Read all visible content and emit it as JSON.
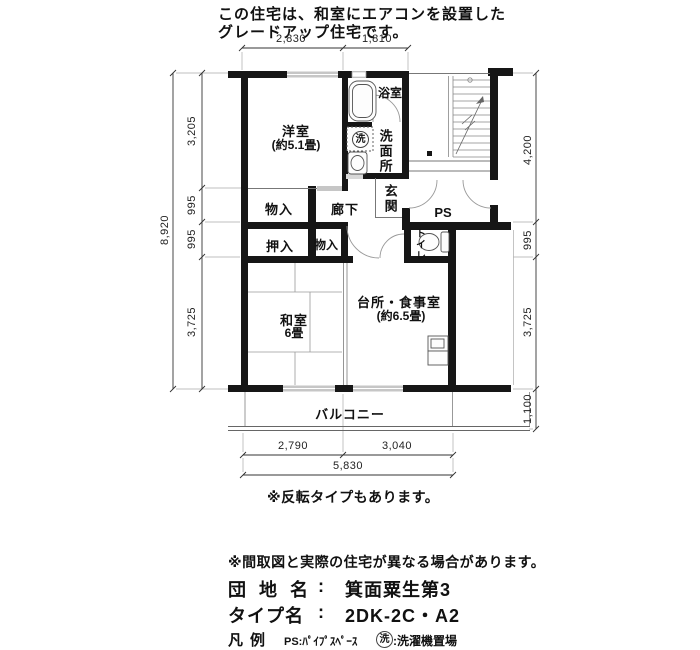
{
  "header": {
    "line1": "この住宅は、和室にエアコンを設置した",
    "line2": "グレードアップ住宅です。"
  },
  "plan": {
    "rooms": {
      "western_room": "洋室",
      "western_room_size": "(約5.1畳)",
      "bathroom": "浴室",
      "washroom": "洗面所",
      "washer_symbol": "洗",
      "entrance": "玄関",
      "corridor": "廊下",
      "storage_upper": "物入",
      "closet": "押入",
      "storage_lower": "物入",
      "toilet": "トイレ",
      "pipe_space": "PS",
      "japanese_room": "和室",
      "japanese_room_size": "6畳",
      "kitchen_dining": "台所・食事室",
      "kitchen_dining_size": "(約6.5畳)",
      "balcony": "バルコニー"
    },
    "dimensions": {
      "top": [
        "2,830",
        "1,810"
      ],
      "left_total": "8,920",
      "left": [
        "3,205",
        "995",
        "995",
        "3,725"
      ],
      "right": [
        "4,200",
        "995",
        "3,725",
        "1,100"
      ],
      "bottom": [
        "2,790",
        "3,040"
      ],
      "bottom_total": "5,830"
    }
  },
  "notes": {
    "flip": "※反転タイプもあります。",
    "disclaimer": "※間取図と実際の住宅が異なる場合があります。"
  },
  "footer": {
    "estate_label": "団 地 名",
    "estate_colon": ":",
    "estate_value": "箕面粟生第3",
    "type_label": "タイプ名",
    "type_colon": ":",
    "type_value": "2DK-2C・A2",
    "legend_label": "凡例",
    "legend_ps": "PS:ﾊﾟｲﾌﾟｽﾍﾟｰｽ",
    "legend_washer_symbol": "洗",
    "legend_washer_text": ":洗濯機置場"
  }
}
